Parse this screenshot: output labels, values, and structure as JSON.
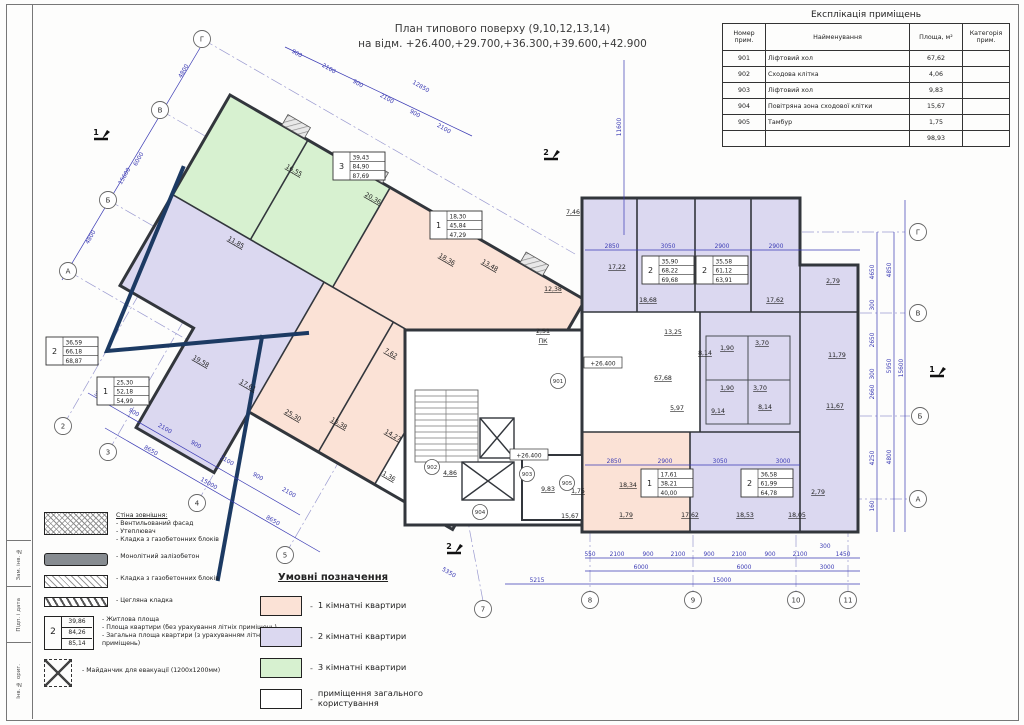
{
  "title": {
    "line1": "План типового поверху (9,10,12,13,14)",
    "line2": "на відм. +26.400,+29.700,+36.300,+39.600,+42.900"
  },
  "explication": {
    "title": "Експлікація приміщень",
    "columns": [
      "Номер прим.",
      "Найменування",
      "Площа, м²",
      "Категорія прим."
    ],
    "rows": [
      [
        "901",
        "Ліфтовий хол",
        "67,62",
        ""
      ],
      [
        "902",
        "Сходова клітка",
        "4,06",
        ""
      ],
      [
        "903",
        "Ліфтовий хол",
        "9,83",
        ""
      ],
      [
        "904",
        "Повітряна зона сходової клітки",
        "15,67",
        ""
      ],
      [
        "905",
        "Тамбур",
        "1,75",
        ""
      ]
    ],
    "total": "98,93"
  },
  "walls_legend": {
    "item1_header": "Стіна зовнішня:",
    "item1_lines": [
      "- Вентильований фасад",
      "- Утеплювач",
      "- Кладка з газобетонних блоків"
    ],
    "item2": "- Монолітний залізобетон",
    "item3": "- Кладка з газобетонних блоків",
    "item4": "- Цегляна кладка",
    "sample": {
      "number": "2",
      "values": [
        "39,86",
        "84,26",
        "85,14"
      ],
      "labels": [
        "- Житлова площа",
        "- Площа квартири (без урахування літніх приміщень)",
        "- Загальна площа квартири (з урахуванням літніх приміщень)"
      ]
    },
    "evacuation": "- Майданчик для евакуації (1200х1200мм)"
  },
  "symbols_legend": {
    "title": "Умовні позначення",
    "items": [
      {
        "color": "#fbe2d6",
        "label": "1 кімнатні квартири"
      },
      {
        "color": "#dbd8f0",
        "label": "2 кімнатні квартири"
      },
      {
        "color": "#d7f1d0",
        "label": "3 кімнатні квартири"
      },
      {
        "color": "#ffffff",
        "label": "приміщення загального користування"
      }
    ]
  },
  "stamp_labels": [
    "Зам. інв. №",
    "Підп. і дата",
    "Інв. № ориг."
  ],
  "plan": {
    "colors": {
      "one_room": "#fbe2d6",
      "two_room": "#dbd8f0",
      "three_room": "#d7f1d0",
      "common": "#ffffff",
      "dim": "#3a3ab4",
      "wall": "#32363c",
      "section": "#1c3a63"
    },
    "apartments": [
      {
        "n": "3",
        "v": [
          "39,43",
          "84,90",
          "87,69"
        ],
        "x": 333,
        "y": 152
      },
      {
        "n": "1",
        "v": [
          "18,30",
          "45,84",
          "47,29"
        ],
        "x": 430,
        "y": 211
      },
      {
        "n": "2",
        "v": [
          "35,90",
          "68,22",
          "69,68"
        ],
        "x": 642,
        "y": 256
      },
      {
        "n": "2",
        "v": [
          "35,58",
          "61,12",
          "63,91"
        ],
        "x": 696,
        "y": 256
      },
      {
        "n": "2",
        "v": [
          "36,59",
          "66,18",
          "68,87"
        ],
        "x": 46,
        "y": 337
      },
      {
        "n": "1",
        "v": [
          "25,30",
          "52,18",
          "54,99"
        ],
        "x": 97,
        "y": 377
      },
      {
        "n": "1",
        "v": [
          "17,61",
          "38,21",
          "40,00"
        ],
        "x": 641,
        "y": 469
      },
      {
        "n": "2",
        "v": [
          "36,58",
          "61,99",
          "64,78"
        ],
        "x": 741,
        "y": 469
      }
    ],
    "room_labels": [
      {
        "t": "16,55",
        "x": 293,
        "y": 172,
        "r": 30
      },
      {
        "t": "20,36",
        "x": 372,
        "y": 200,
        "r": 30
      },
      {
        "t": "11,85",
        "x": 235,
        "y": 244,
        "r": 30
      },
      {
        "t": "18,36",
        "x": 446,
        "y": 261,
        "r": 30
      },
      {
        "t": "13,48",
        "x": 489,
        "y": 267,
        "r": 30
      },
      {
        "t": "19,58",
        "x": 200,
        "y": 363,
        "r": 30
      },
      {
        "t": "17,61",
        "x": 247,
        "y": 387,
        "r": 30
      },
      {
        "t": "25,30",
        "x": 292,
        "y": 417,
        "r": 30
      },
      {
        "t": "15,38",
        "x": 338,
        "y": 425,
        "r": 30
      },
      {
        "t": "14,27",
        "x": 392,
        "y": 437,
        "r": 30
      },
      {
        "t": "7,62",
        "x": 390,
        "y": 355,
        "r": 30
      },
      {
        "t": "1,36",
        "x": 388,
        "y": 478,
        "r": 30
      },
      {
        "t": "7,46",
        "x": 573,
        "y": 214,
        "r": 0
      },
      {
        "t": "12,38",
        "x": 553,
        "y": 291,
        "r": 0
      },
      {
        "t": "17,22",
        "x": 617,
        "y": 269,
        "r": 0
      },
      {
        "t": "18,68",
        "x": 648,
        "y": 302,
        "r": 0
      },
      {
        "t": "17,62",
        "x": 775,
        "y": 302,
        "r": 0
      },
      {
        "t": "2,79",
        "x": 833,
        "y": 283,
        "r": 0
      },
      {
        "t": "13,25",
        "x": 673,
        "y": 334,
        "r": 0
      },
      {
        "t": "2,51",
        "x": 543,
        "y": 333,
        "r": 0
      },
      {
        "t": "ПК",
        "x": 543,
        "y": 343,
        "r": 0
      },
      {
        "t": "8,14",
        "x": 705,
        "y": 355,
        "r": 0
      },
      {
        "t": "1,90",
        "x": 727,
        "y": 350,
        "r": 0
      },
      {
        "t": "3,70",
        "x": 762,
        "y": 345,
        "r": 0
      },
      {
        "t": "1,90",
        "x": 727,
        "y": 390,
        "r": 0
      },
      {
        "t": "3,70",
        "x": 760,
        "y": 390,
        "r": 0
      },
      {
        "t": "11,79",
        "x": 837,
        "y": 357,
        "r": 0
      },
      {
        "t": "67,68",
        "x": 663,
        "y": 380,
        "r": 0
      },
      {
        "t": "5,97",
        "x": 677,
        "y": 410,
        "r": 0
      },
      {
        "t": "9,14",
        "x": 718,
        "y": 413,
        "r": 0
      },
      {
        "t": "8,14",
        "x": 765,
        "y": 409,
        "r": 0
      },
      {
        "t": "11,67",
        "x": 835,
        "y": 408,
        "r": 0
      },
      {
        "t": "4,86",
        "x": 450,
        "y": 475,
        "r": 0
      },
      {
        "t": "9,83",
        "x": 548,
        "y": 491,
        "r": 0
      },
      {
        "t": "1,75",
        "x": 578,
        "y": 493,
        "r": 0
      },
      {
        "t": "15,67",
        "x": 570,
        "y": 518,
        "r": 0
      },
      {
        "t": "18,34",
        "x": 628,
        "y": 487,
        "r": 0
      },
      {
        "t": "1,79",
        "x": 626,
        "y": 517,
        "r": 0
      },
      {
        "t": "17,62",
        "x": 690,
        "y": 517,
        "r": 0
      },
      {
        "t": "18,53",
        "x": 745,
        "y": 517,
        "r": 0
      },
      {
        "t": "18,05",
        "x": 797,
        "y": 517,
        "r": 0
      },
      {
        "t": "2,79",
        "x": 818,
        "y": 494,
        "r": 0
      }
    ],
    "axis_circles": [
      {
        "t": "Г",
        "x": 202,
        "y": 39
      },
      {
        "t": "В",
        "x": 160,
        "y": 110
      },
      {
        "t": "Б",
        "x": 108,
        "y": 200
      },
      {
        "t": "А",
        "x": 68,
        "y": 271
      },
      {
        "t": "2",
        "x": 63,
        "y": 426
      },
      {
        "t": "3",
        "x": 108,
        "y": 452
      },
      {
        "t": "4",
        "x": 197,
        "y": 503
      },
      {
        "t": "5",
        "x": 285,
        "y": 555
      },
      {
        "t": "7",
        "x": 483,
        "y": 609
      },
      {
        "t": "8",
        "x": 590,
        "y": 600
      },
      {
        "t": "9",
        "x": 693,
        "y": 600
      },
      {
        "t": "10",
        "x": 796,
        "y": 600
      },
      {
        "t": "11",
        "x": 848,
        "y": 600
      },
      {
        "t": "Г",
        "x": 918,
        "y": 232
      },
      {
        "t": "В",
        "x": 918,
        "y": 313
      },
      {
        "t": "Б",
        "x": 920,
        "y": 416
      },
      {
        "t": "А",
        "x": 918,
        "y": 499
      }
    ],
    "room_circles": [
      {
        "t": "901",
        "x": 558,
        "y": 381
      },
      {
        "t": "902",
        "x": 432,
        "y": 467
      },
      {
        "t": "903",
        "x": 527,
        "y": 474
      },
      {
        "t": "904",
        "x": 480,
        "y": 512
      },
      {
        "t": "905",
        "x": 567,
        "y": 483
      }
    ],
    "dims": [
      {
        "t": "550",
        "x": 590,
        "y": 556,
        "r": 0
      },
      {
        "t": "2100",
        "x": 617,
        "y": 556,
        "r": 0
      },
      {
        "t": "900",
        "x": 648,
        "y": 556,
        "r": 0
      },
      {
        "t": "2100",
        "x": 678,
        "y": 556,
        "r": 0
      },
      {
        "t": "900",
        "x": 709,
        "y": 556,
        "r": 0
      },
      {
        "t": "2100",
        "x": 739,
        "y": 556,
        "r": 0
      },
      {
        "t": "900",
        "x": 770,
        "y": 556,
        "r": 0
      },
      {
        "t": "2100",
        "x": 800,
        "y": 556,
        "r": 0
      },
      {
        "t": "300",
        "x": 825,
        "y": 548,
        "r": 0
      },
      {
        "t": "1450",
        "x": 843,
        "y": 556,
        "r": 0
      },
      {
        "t": "6000",
        "x": 641,
        "y": 569,
        "r": 0
      },
      {
        "t": "6000",
        "x": 744,
        "y": 569,
        "r": 0
      },
      {
        "t": "3000",
        "x": 827,
        "y": 569,
        "r": 0
      },
      {
        "t": "5215",
        "x": 537,
        "y": 582,
        "r": 0
      },
      {
        "t": "15000",
        "x": 722,
        "y": 582,
        "r": 0
      },
      {
        "t": "5350",
        "x": 448,
        "y": 574,
        "r": 30
      },
      {
        "t": "2850",
        "x": 612,
        "y": 248,
        "r": 0
      },
      {
        "t": "3050",
        "x": 668,
        "y": 248,
        "r": 0
      },
      {
        "t": "2900",
        "x": 722,
        "y": 248,
        "r": 0
      },
      {
        "t": "2900",
        "x": 776,
        "y": 248,
        "r": 0
      },
      {
        "t": "2850",
        "x": 614,
        "y": 463,
        "r": 0
      },
      {
        "t": "2900",
        "x": 665,
        "y": 463,
        "r": 0
      },
      {
        "t": "3050",
        "x": 720,
        "y": 463,
        "r": 0
      },
      {
        "t": "3000",
        "x": 783,
        "y": 463,
        "r": 0
      },
      {
        "t": "4650",
        "x": 874,
        "y": 272,
        "r": -90
      },
      {
        "t": "300",
        "x": 874,
        "y": 305,
        "r": -90
      },
      {
        "t": "2650",
        "x": 874,
        "y": 340,
        "r": -90
      },
      {
        "t": "300",
        "x": 874,
        "y": 374,
        "r": -90
      },
      {
        "t": "2660",
        "x": 874,
        "y": 392,
        "r": -90
      },
      {
        "t": "4250",
        "x": 874,
        "y": 458,
        "r": -90
      },
      {
        "t": "160",
        "x": 874,
        "y": 506,
        "r": -90
      },
      {
        "t": "4850",
        "x": 891,
        "y": 270,
        "r": -90
      },
      {
        "t": "5950",
        "x": 891,
        "y": 366,
        "r": -90
      },
      {
        "t": "4800",
        "x": 891,
        "y": 457,
        "r": -90
      },
      {
        "t": "15600",
        "x": 903,
        "y": 368,
        "r": -90
      },
      {
        "t": "11600",
        "x": 621,
        "y": 127,
        "r": -90
      },
      {
        "t": "4800",
        "x": 185,
        "y": 72,
        "r": -60
      },
      {
        "t": "6000",
        "x": 140,
        "y": 160,
        "r": -60
      },
      {
        "t": "15600",
        "x": 126,
        "y": 177,
        "r": -60
      },
      {
        "t": "4800",
        "x": 92,
        "y": 238,
        "r": -60
      },
      {
        "t": "900",
        "x": 296,
        "y": 55,
        "r": 30
      },
      {
        "t": "2100",
        "x": 328,
        "y": 70,
        "r": 30
      },
      {
        "t": "900",
        "x": 357,
        "y": 85,
        "r": 30
      },
      {
        "t": "2100",
        "x": 386,
        "y": 100,
        "r": 30
      },
      {
        "t": "900",
        "x": 414,
        "y": 115,
        "r": 30
      },
      {
        "t": "2100",
        "x": 443,
        "y": 130,
        "r": 30
      },
      {
        "t": "12850",
        "x": 420,
        "y": 88,
        "r": 30
      },
      {
        "t": "3650",
        "x": 100,
        "y": 398,
        "r": 30
      },
      {
        "t": "900",
        "x": 133,
        "y": 414,
        "r": 30
      },
      {
        "t": "2100",
        "x": 164,
        "y": 430,
        "r": 30
      },
      {
        "t": "900",
        "x": 195,
        "y": 446,
        "r": 30
      },
      {
        "t": "2100",
        "x": 226,
        "y": 462,
        "r": 30
      },
      {
        "t": "900",
        "x": 257,
        "y": 478,
        "r": 30
      },
      {
        "t": "2100",
        "x": 288,
        "y": 494,
        "r": 30
      },
      {
        "t": "8650",
        "x": 150,
        "y": 452,
        "r": 30
      },
      {
        "t": "15000",
        "x": 208,
        "y": 485,
        "r": 30
      },
      {
        "t": "8650",
        "x": 272,
        "y": 522,
        "r": 30
      }
    ],
    "levels": [
      {
        "t": "+26.400",
        "x": 603,
        "y": 363
      },
      {
        "t": "+26.400",
        "x": 529,
        "y": 455
      }
    ],
    "sections": [
      {
        "t": "1",
        "x": 96,
        "y": 133
      },
      {
        "t": "2",
        "x": 449,
        "y": 547
      },
      {
        "t": "2",
        "x": 546,
        "y": 153
      },
      {
        "t": "1",
        "x": 932,
        "y": 370
      }
    ]
  }
}
